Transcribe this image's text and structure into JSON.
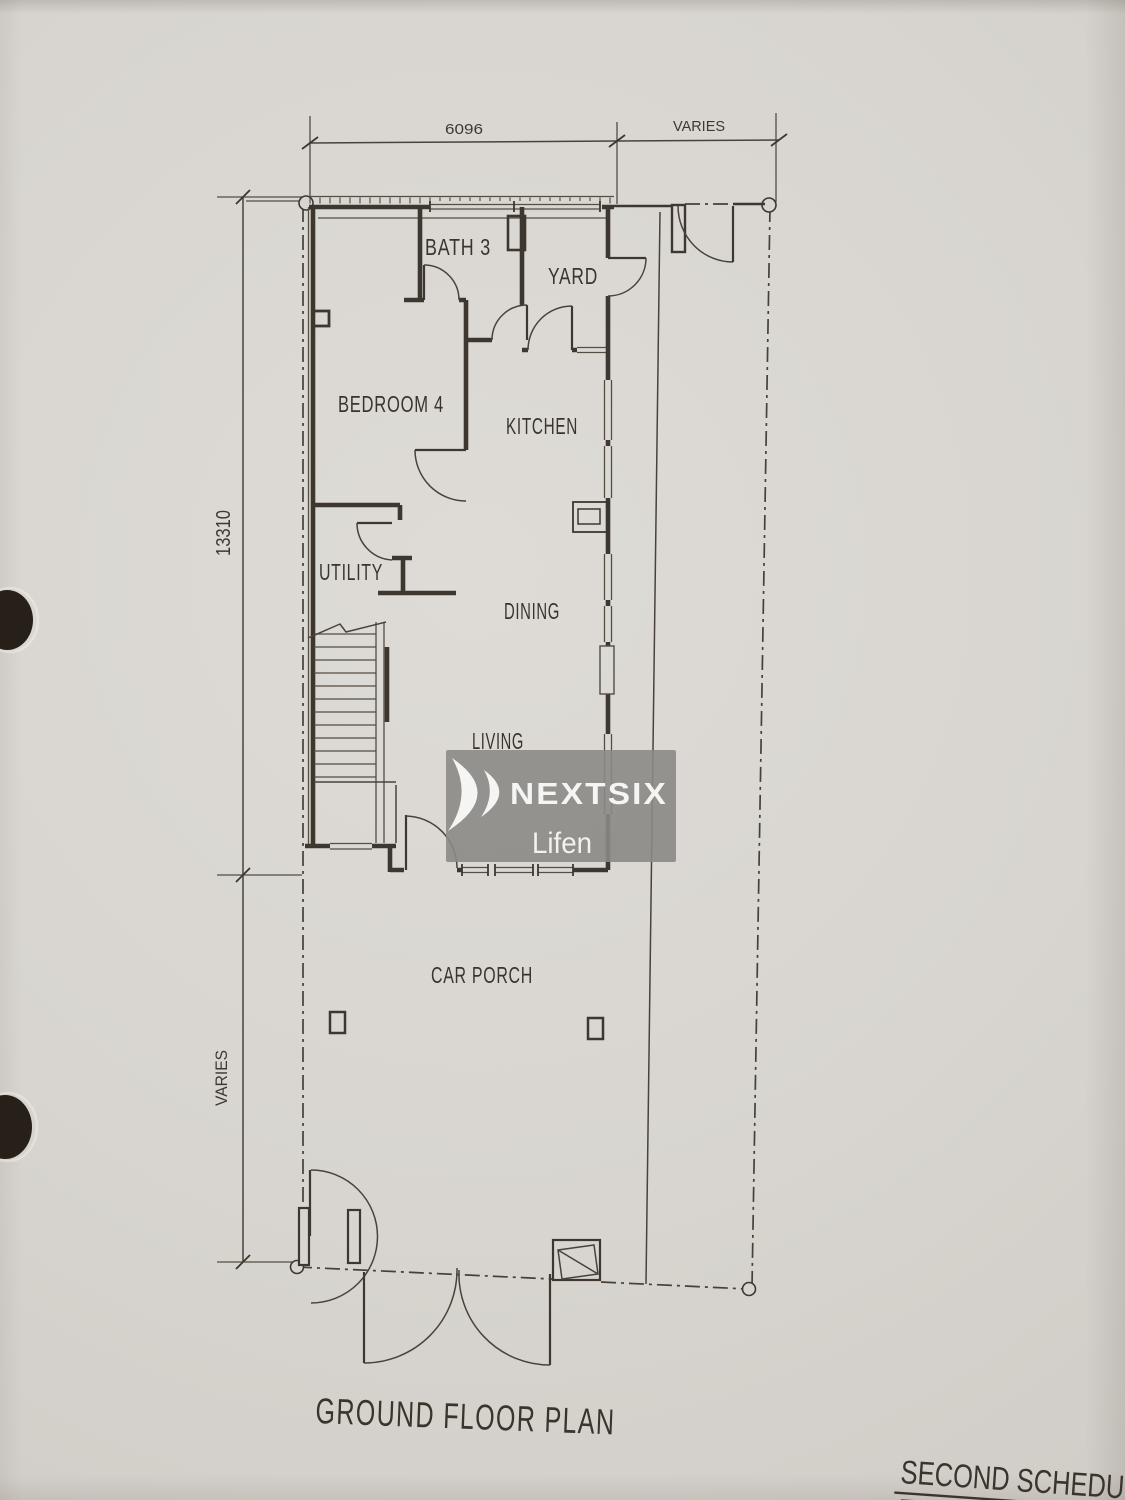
{
  "page": {
    "title": "GROUND FLOOR PLAN",
    "schedule_heading": "SECOND SCHEDU",
    "dims": {
      "top_width": "6096",
      "top_side": "VARIES",
      "left_depth": "13310",
      "left_front": "VARIES"
    },
    "rooms": {
      "bath3": "BATH 3",
      "yard": "YARD",
      "bedroom4": "BEDROOM 4",
      "kitchen": "KITCHEN",
      "utility": "UTILITY",
      "dining": "DINING",
      "living": "LIVING",
      "car_porch": "CAR PORCH"
    },
    "watermark": {
      "brand": "NEXTSIX",
      "name": "Lifen"
    },
    "colors": {
      "paper": "#d8d5d0",
      "ink": "#3d372f",
      "watermark_bg": "#8b8a86",
      "watermark_text": "#f5f5f3"
    }
  }
}
